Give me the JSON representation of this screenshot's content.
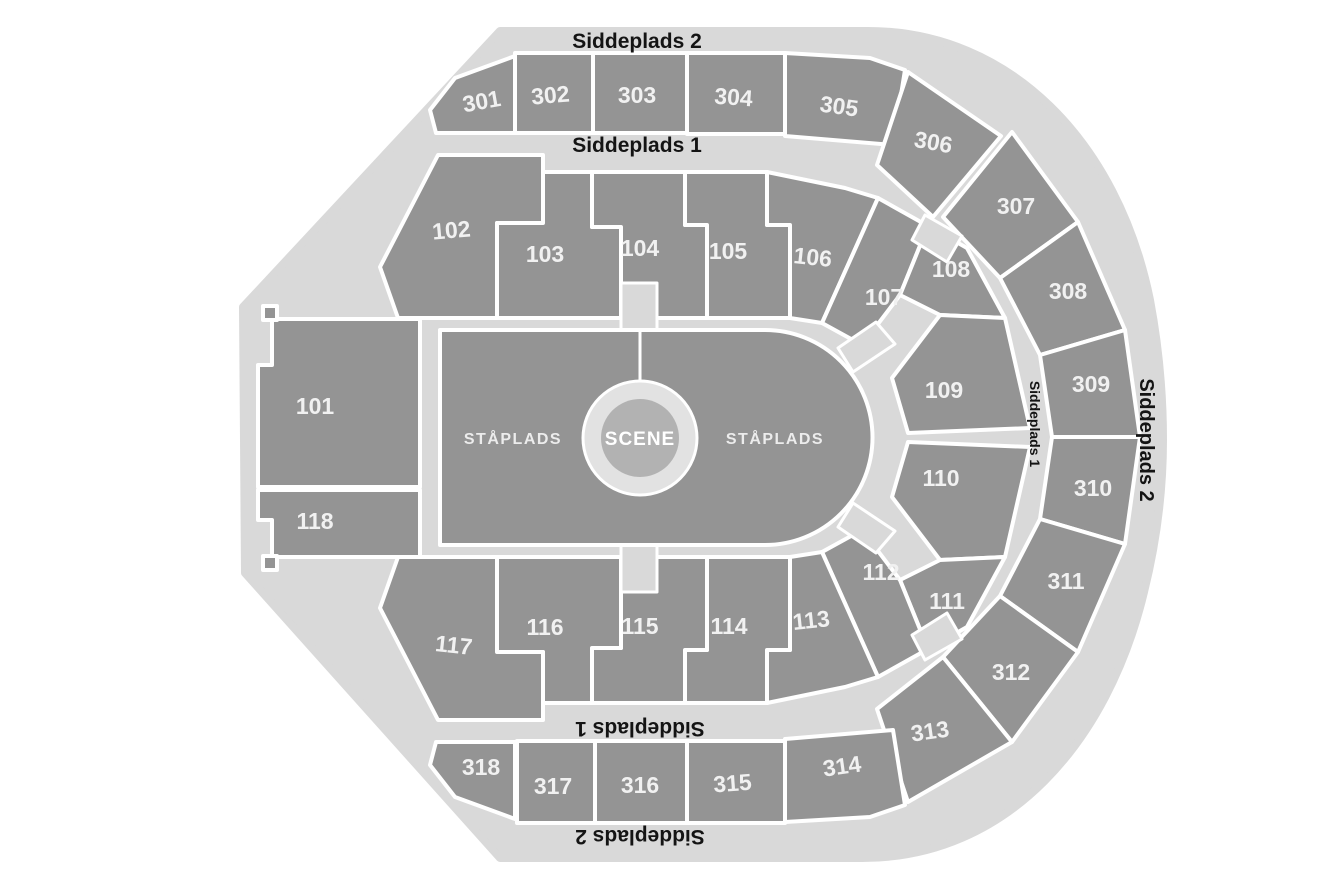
{
  "labels": {
    "tier2_top": "Siddeplads 2",
    "tier1_top": "Siddeplads 1",
    "tier1_bottom": "Siddeplads 1",
    "tier2_bottom": "Siddeplads 2",
    "tier1_right": "Siddeplads 1",
    "tier2_right": "Siddeplads 2"
  },
  "stage": {
    "label": "SCENE"
  },
  "floor": {
    "left_label": "STÅPLADS",
    "right_label": "STÅPLADS"
  },
  "sections": {
    "lower": [
      {
        "label": "101"
      },
      {
        "label": "102"
      },
      {
        "label": "103"
      },
      {
        "label": "104"
      },
      {
        "label": "105"
      },
      {
        "label": "106"
      },
      {
        "label": "107"
      },
      {
        "label": "108"
      },
      {
        "label": "109"
      },
      {
        "label": "110"
      },
      {
        "label": "111"
      },
      {
        "label": "112"
      },
      {
        "label": "113"
      },
      {
        "label": "114"
      },
      {
        "label": "115"
      },
      {
        "label": "116"
      },
      {
        "label": "117"
      },
      {
        "label": "118"
      }
    ],
    "upper": [
      {
        "label": "301"
      },
      {
        "label": "302"
      },
      {
        "label": "303"
      },
      {
        "label": "304"
      },
      {
        "label": "305"
      },
      {
        "label": "306"
      },
      {
        "label": "307"
      },
      {
        "label": "308"
      },
      {
        "label": "309"
      },
      {
        "label": "310"
      },
      {
        "label": "311"
      },
      {
        "label": "312"
      },
      {
        "label": "313"
      },
      {
        "label": "314"
      },
      {
        "label": "315"
      },
      {
        "label": "316"
      },
      {
        "label": "317"
      },
      {
        "label": "318"
      }
    ]
  },
  "colors": {
    "section_fill": "#949494",
    "concourse": "#d9d9d9",
    "stage_inner": "#b2b2b2",
    "stage_ring": "#e2e2e2",
    "section_label": "#f1f1f1",
    "heading": "#141414",
    "background": "#ffffff"
  }
}
